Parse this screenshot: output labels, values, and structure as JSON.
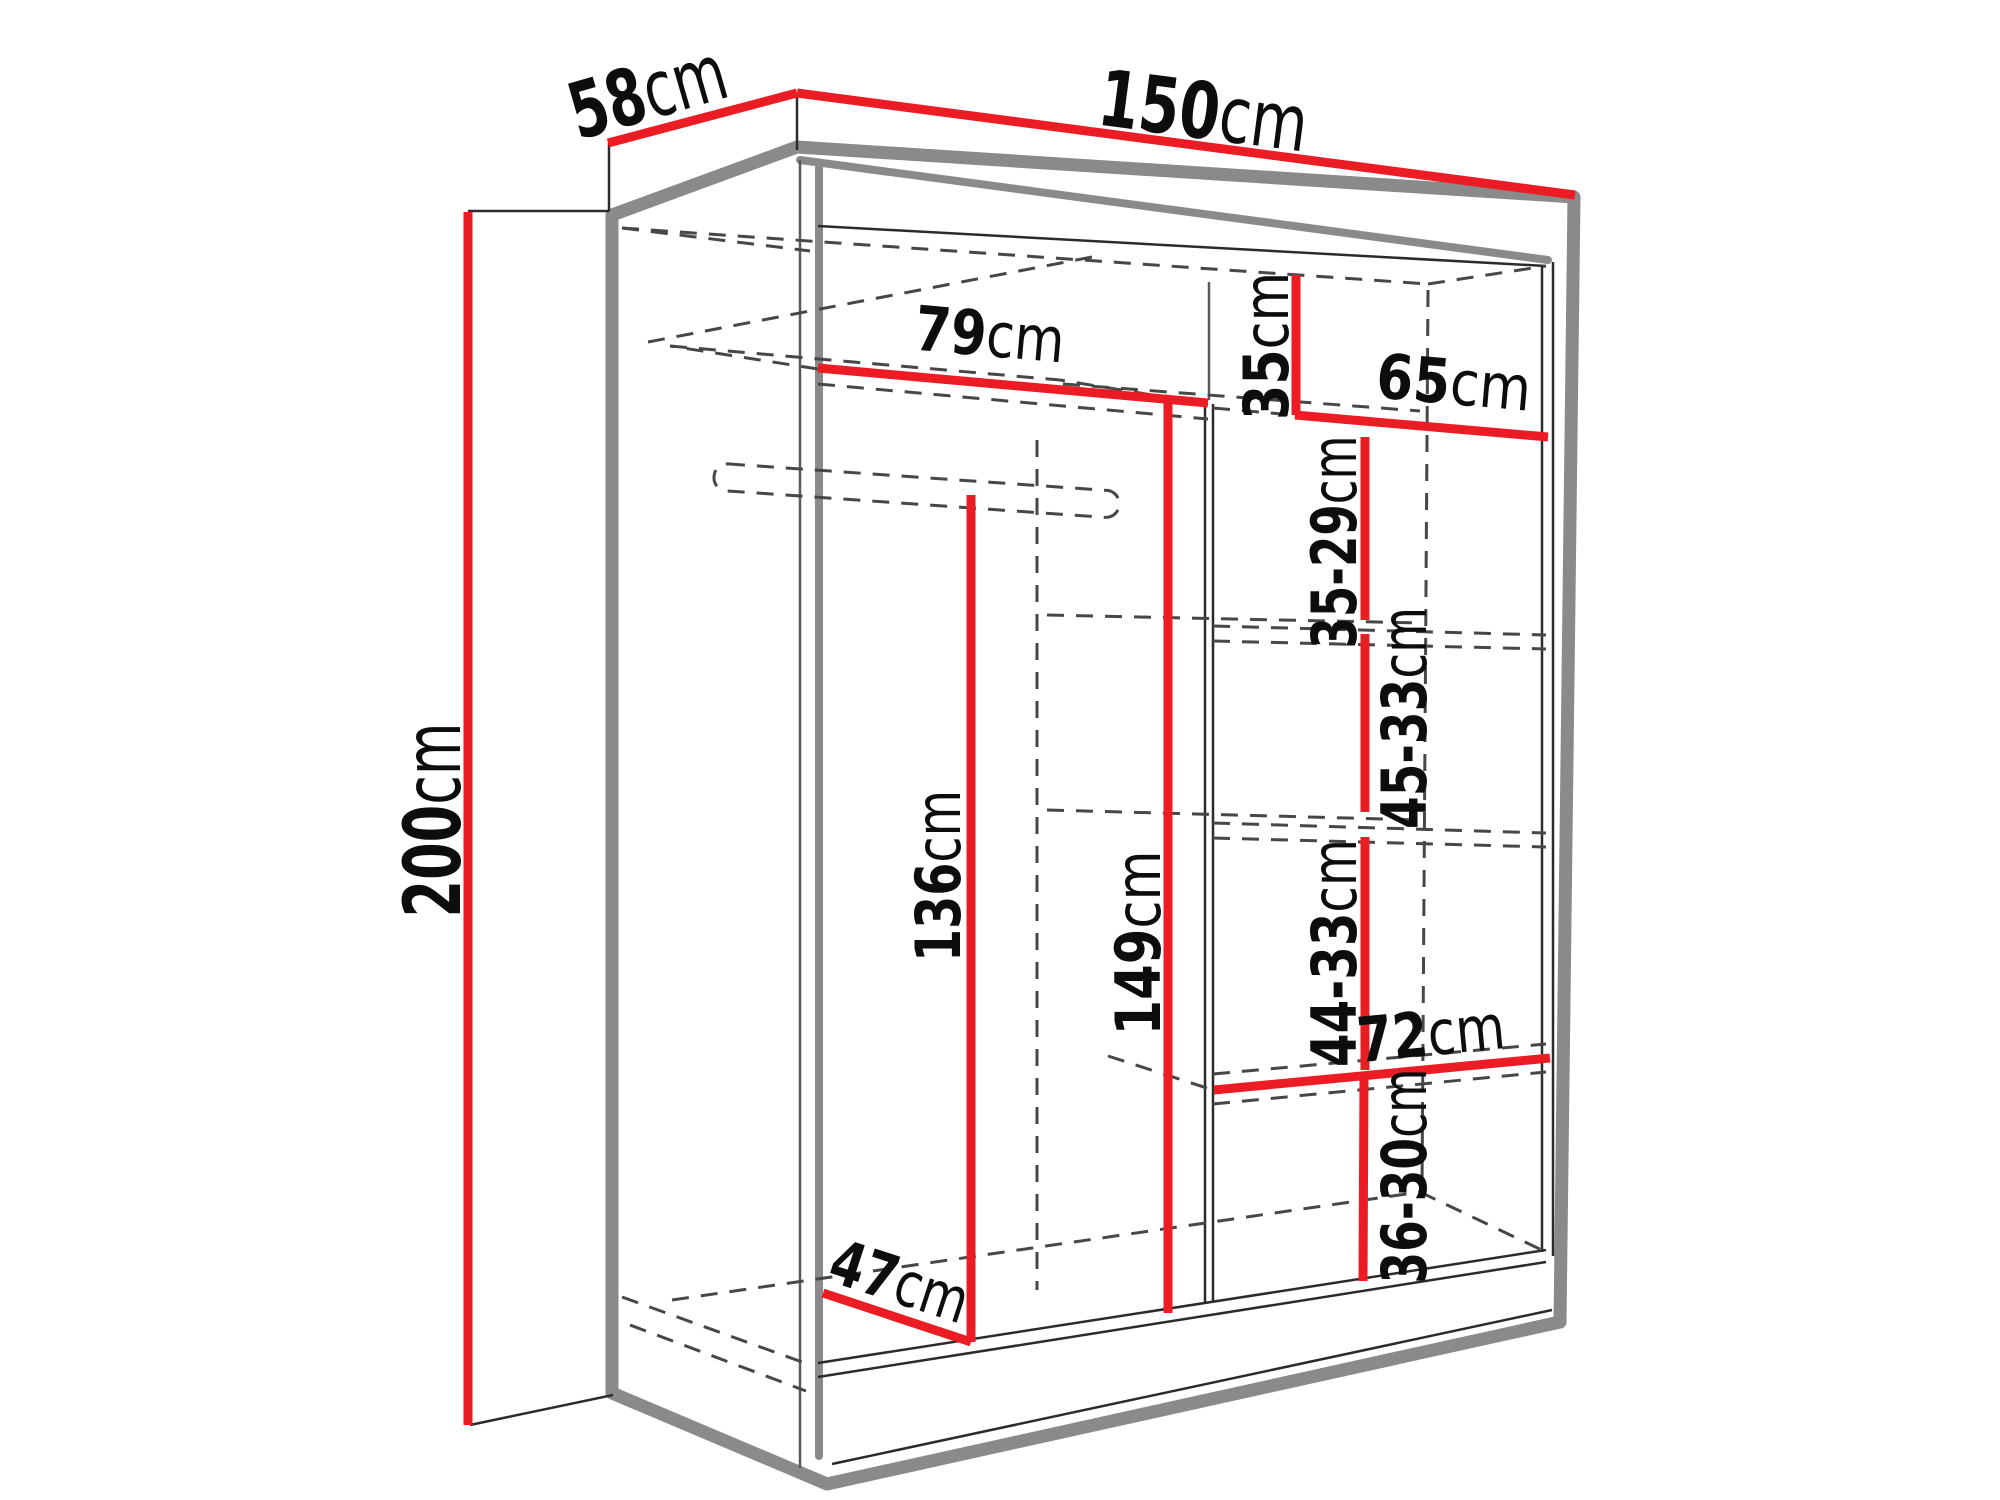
{
  "diagram": {
    "type": "furniture-dimension-drawing",
    "subject": "sliding-door wardrobe, open front with shelves and hanging rod",
    "units": "cm"
  },
  "dims": {
    "width": {
      "value": "150",
      "unit": "cm"
    },
    "depth": {
      "value": "58",
      "unit": "cm"
    },
    "height": {
      "value": "200",
      "unit": "cm"
    },
    "left_shelf_width": {
      "value": "79",
      "unit": "cm"
    },
    "left_hanging_height": {
      "value": "136",
      "unit": "cm"
    },
    "bottom_depth": {
      "value": "47",
      "unit": "cm"
    },
    "middle_height": {
      "value": "149",
      "unit": "cm"
    },
    "right_top_gap": {
      "value": "35",
      "unit": "cm"
    },
    "right_width_top": {
      "value": "65",
      "unit": "cm"
    },
    "right_gap_1": {
      "value": "35-29",
      "unit": "cm"
    },
    "right_gap_2": {
      "value": "45-33",
      "unit": "cm"
    },
    "right_gap_3": {
      "value": "44-33",
      "unit": "cm"
    },
    "right_width_bottom": {
      "value": "72",
      "unit": "cm"
    },
    "right_gap_4": {
      "value": "36-30",
      "unit": "cm"
    }
  },
  "colors": {
    "dimension_line": "#ec1c24",
    "outline": "#8a8a8a",
    "detail_line": "#2b2b2b",
    "hidden_edge": "#474747",
    "text": "#0d0d0d",
    "background": "#ffffff"
  }
}
